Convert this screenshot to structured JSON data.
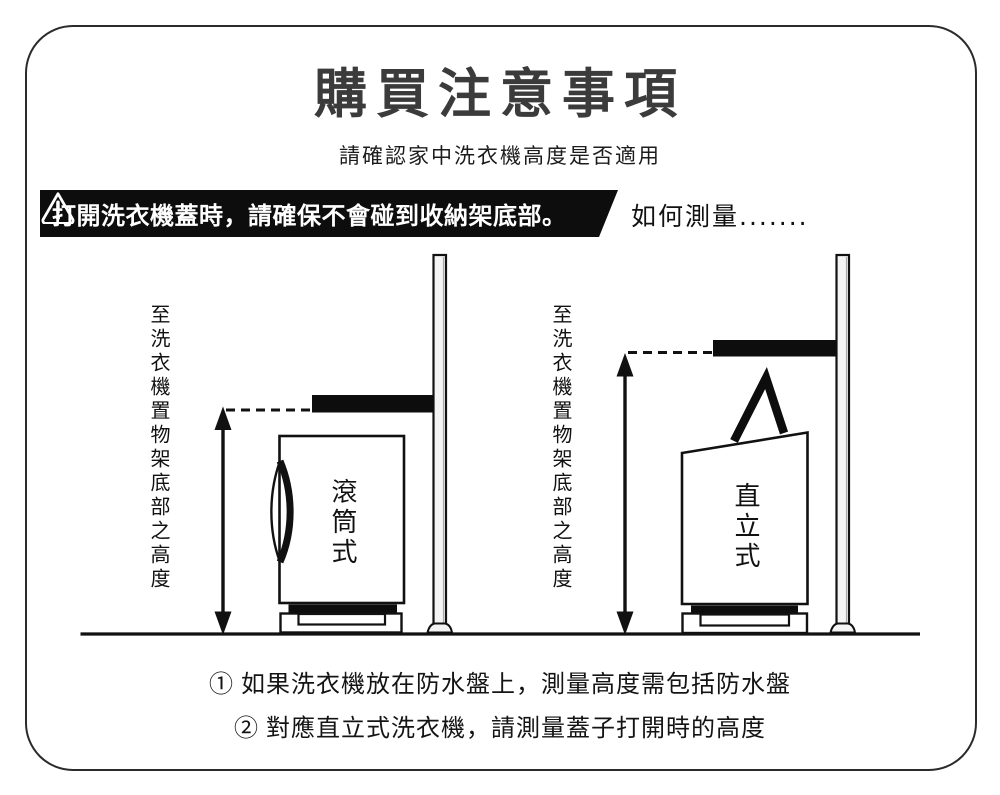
{
  "page": {
    "title": "購買注意事項",
    "subtitle": "請確認家中洗衣機高度是否適用"
  },
  "warning_banner": {
    "icon": "warning-triangle",
    "text": "打開洗衣機蓋時，請確保不會碰到收納架底部。"
  },
  "how_to_measure_label": "如何測量.......",
  "diagrams": {
    "front_load": {
      "height_label": "至洗衣機置物架底部之高度",
      "machine_label": "滾筒式"
    },
    "top_load": {
      "height_label": "至洗衣機置物架底部之高度",
      "machine_label": "直立式"
    }
  },
  "notes": {
    "line1": "① 如果洗衣機放在防水盤上，測量高度需包括防水盤",
    "line2": "② 對應直立式洗衣機，請測量蓋子打開時的高度"
  },
  "colors": {
    "ink": "#111111",
    "title_ink": "#3b3b3b",
    "banner_bg": "#0d0d0d",
    "banner_text": "#ffffff",
    "pole_fill": "#f4f4f4"
  }
}
